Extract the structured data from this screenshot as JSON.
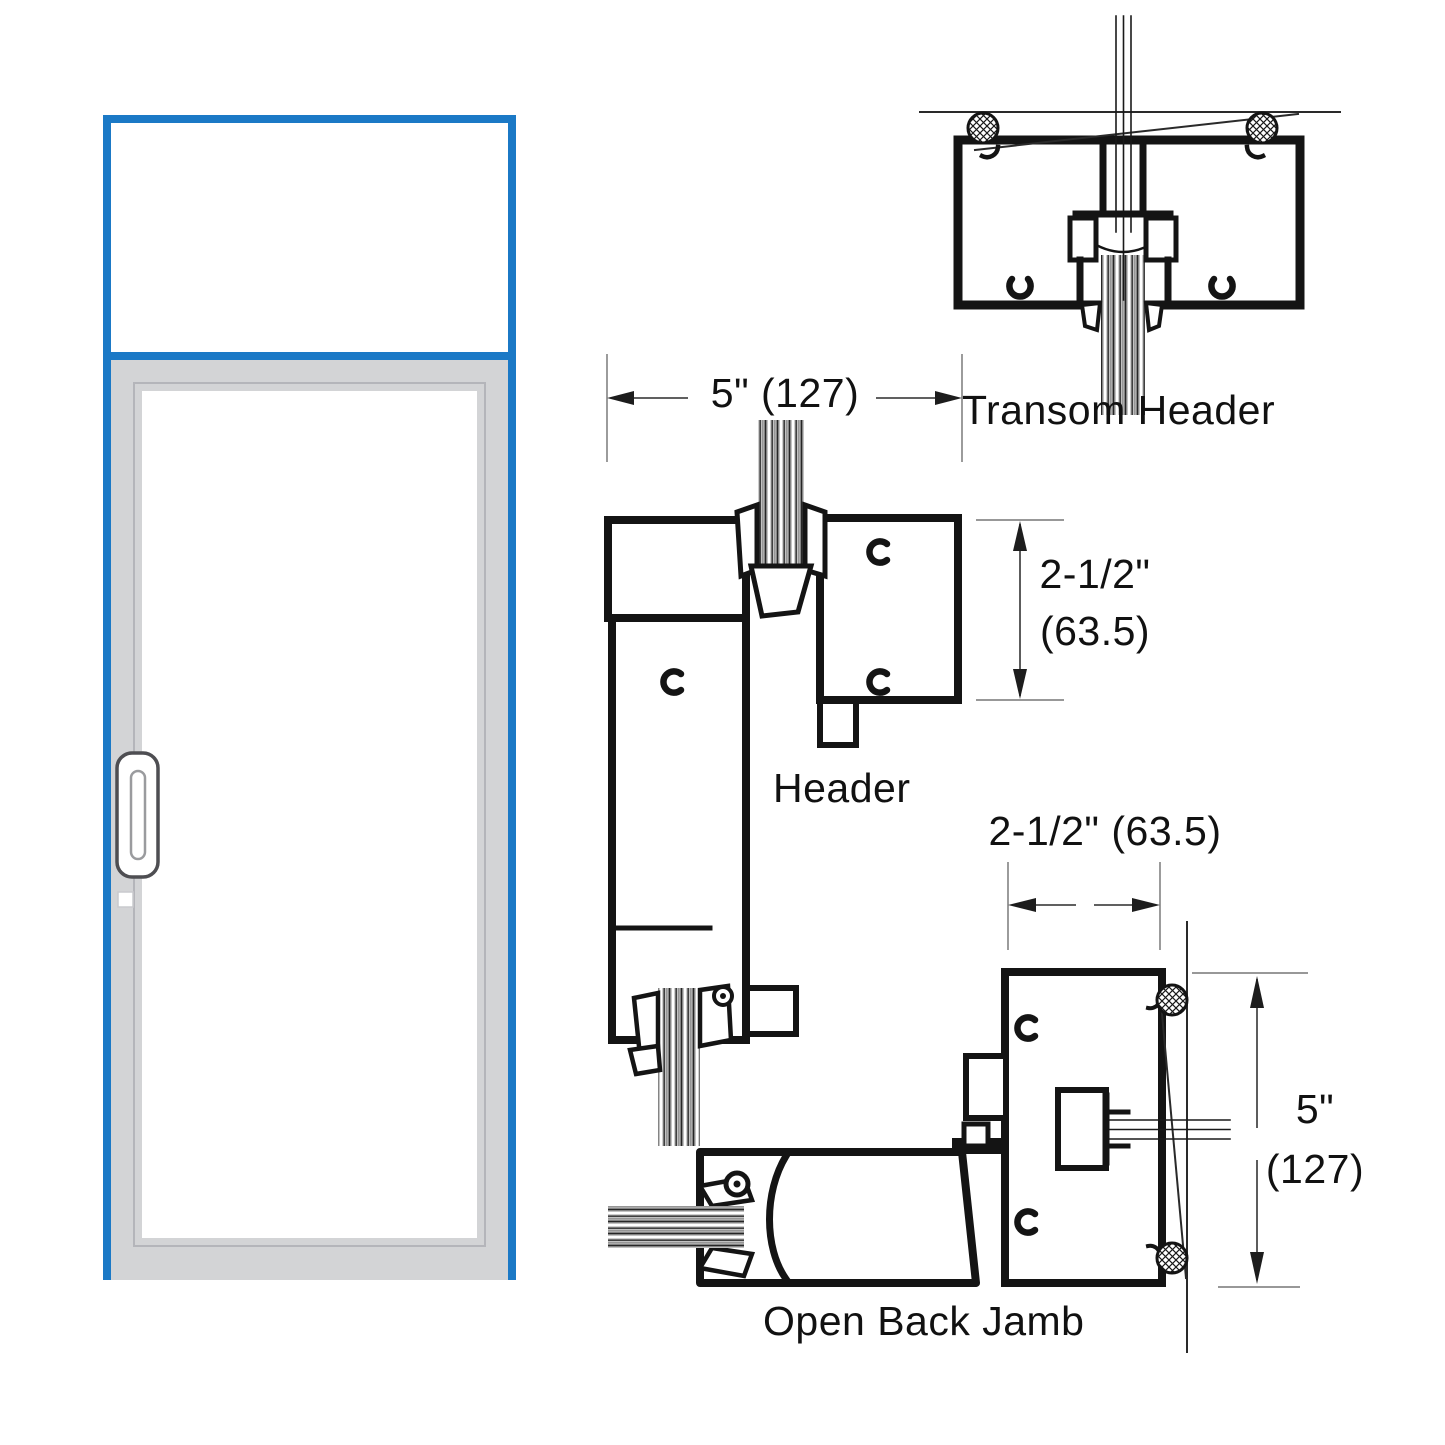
{
  "drawing": {
    "title": "Storefront door with transom - frame section details",
    "labels": {
      "transom_header": "Transom Header",
      "header": "Header",
      "open_back_jamb": "Open Back Jamb"
    },
    "dimensions": {
      "transom_depth": "5\" (127)",
      "header_face_in": "2-1/2\"",
      "header_face_mm": "(63.5)",
      "jamb_face": "2-1/2\" (63.5)",
      "jamb_depth_in": "5\"",
      "jamb_depth_mm": "(127)"
    },
    "colors": {
      "accent_blue": "#1b79c6",
      "frame_gray": "#d3d4d6",
      "line_black": "#141414"
    }
  }
}
